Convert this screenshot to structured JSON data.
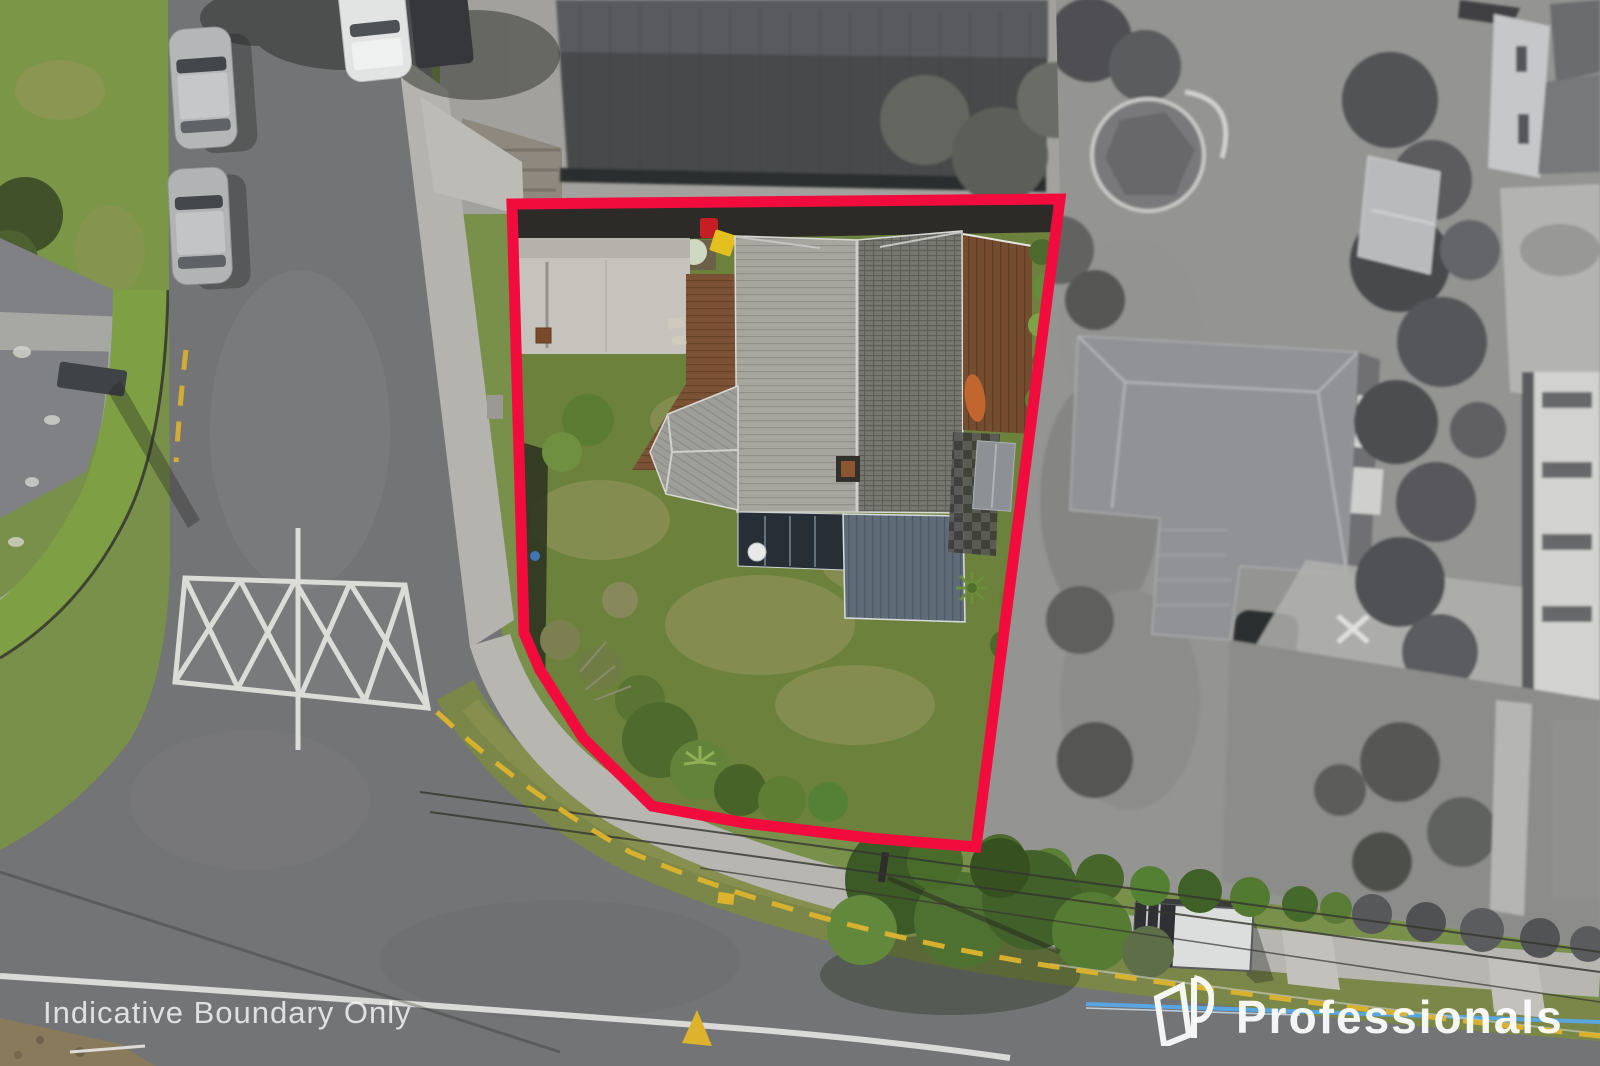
{
  "watermark": {
    "disclaimer": "Indicative Boundary Only"
  },
  "brand": {
    "name": "Professionals"
  },
  "boundary": {
    "color": "#F20C3E"
  }
}
